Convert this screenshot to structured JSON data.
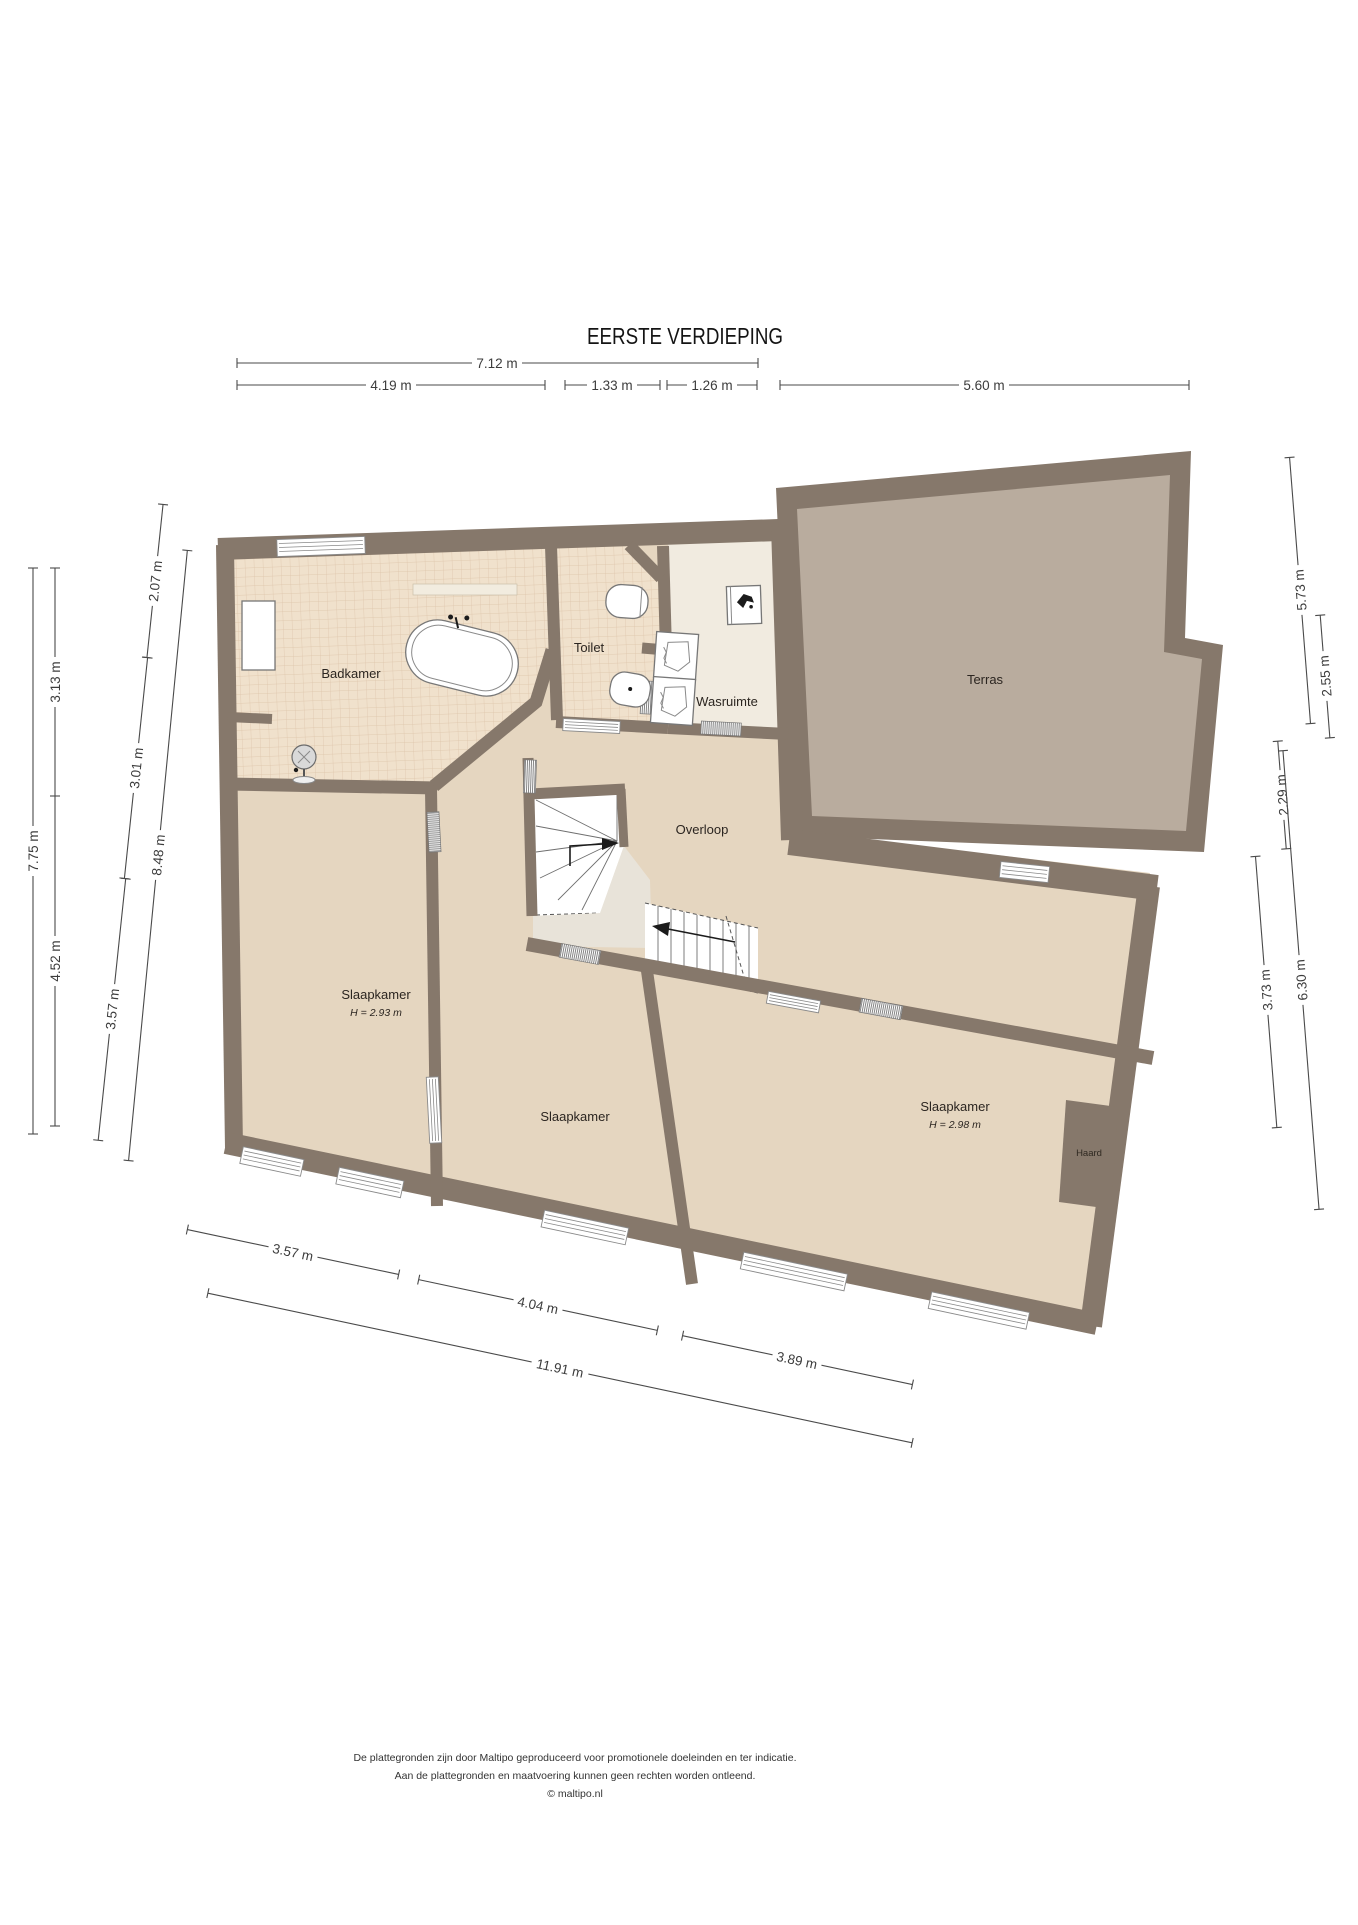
{
  "title": "EERSTE VERDIEPING",
  "colors": {
    "wall": "#86786B",
    "floor_bedroom": "#E5D6C0",
    "floor_tile": "#F0E1CC",
    "tile_grid": "#DCC3A9",
    "floor_utility": "#F1EBE0",
    "floor_terrace": "#B9AC9E",
    "floor_landing": "#E8E3D9",
    "dimension_lines": "#4A4A4A",
    "background": "#FFFFFF"
  },
  "rooms": {
    "badkamer": "Badkamer",
    "toilet": "Toilet",
    "wasruimte": "Wasruimte",
    "terras": "Terras",
    "overloop": "Overloop",
    "slaapkamer": "Slaapkamer",
    "slaapkamer_left_height": "H = 2.93 m",
    "slaapkamer_right_height": "H = 2.98 m",
    "haard": "Haard"
  },
  "dimensions": {
    "top": {
      "total": "7.12 m",
      "seg1": "4.19 m",
      "seg2": "1.33 m",
      "seg3": "1.26 m",
      "terrace": "5.60 m"
    },
    "left": {
      "total": "7.75 m",
      "upper": "3.13 m",
      "lower": "4.52 m",
      "wall_upper": "2.07 m",
      "wall_mid": "3.01 m",
      "wall_lower": "3.57 m",
      "wall_total": "8.48 m"
    },
    "right": {
      "terrace": "5.73 m",
      "terrace_lower": "2.55 m",
      "hall": "2.29 m",
      "bedroom": "3.73 m",
      "total": "6.30 m"
    },
    "bottom": {
      "seg1": "3.57 m",
      "seg2": "4.04 m",
      "seg3": "3.89 m",
      "total": "11.91 m"
    }
  },
  "footer": {
    "line1": "De plattegronden zijn door Maltipo geproduceerd voor promotionele doeleinden en ter indicatie.",
    "line2": "Aan de plattegronden en maatvoering kunnen geen rechten worden ontleend.",
    "line3": "© maltipo.nl"
  }
}
